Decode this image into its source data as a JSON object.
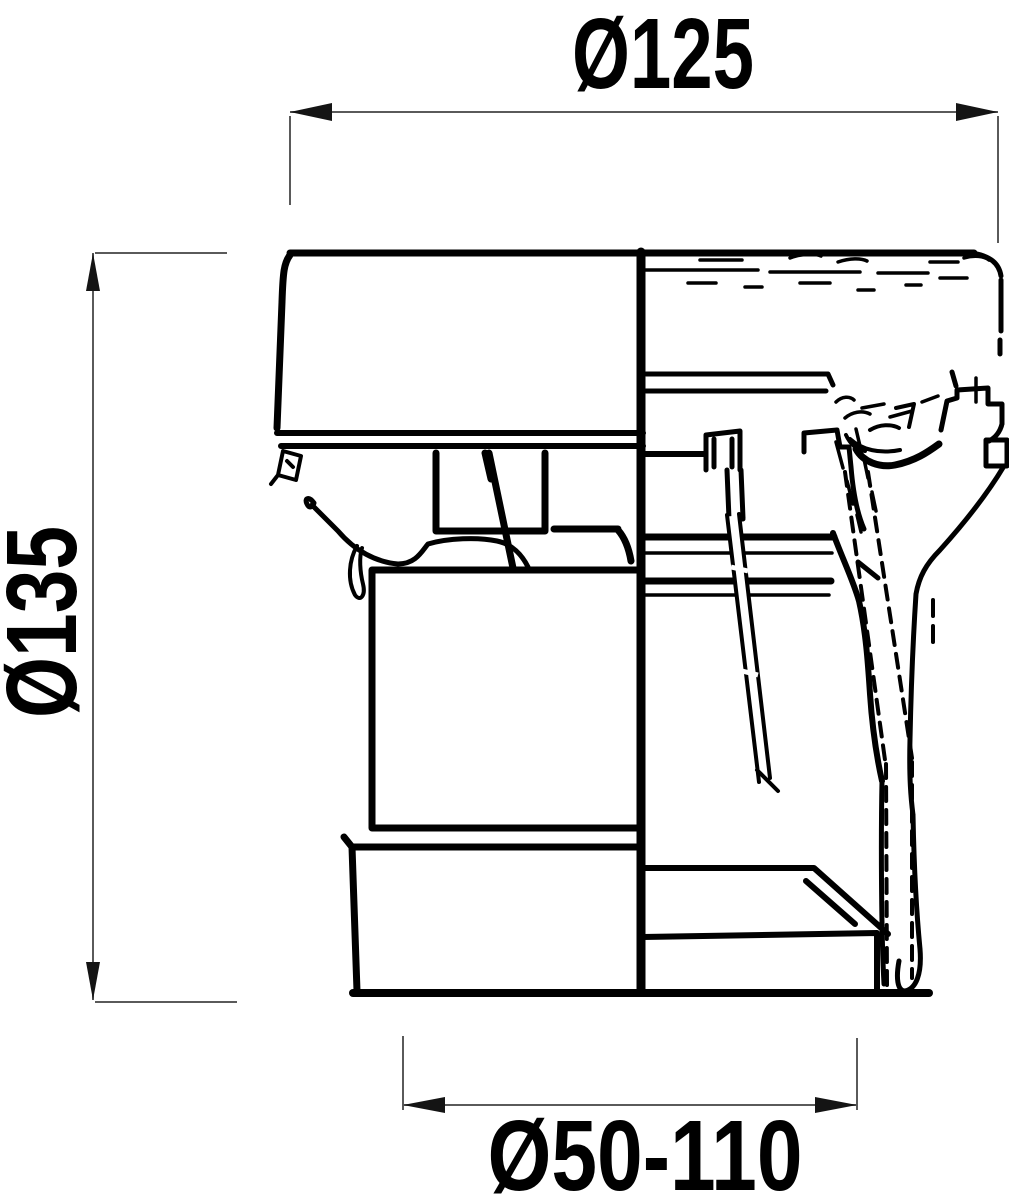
{
  "page": {
    "background": "#ffffff"
  },
  "drawing": {
    "kind": "technical-section-drawing",
    "subject": "vent-cap-cross-section",
    "line_color": "#000000",
    "dimension_line_color": "#5a5a5a",
    "text_color": "#000000",
    "dimensions": {
      "top": {
        "label": "Ø125",
        "value": 125,
        "symbol": "Ø"
      },
      "left": {
        "label": "Ø135",
        "value": 135,
        "symbol": "Ø"
      },
      "bottom": {
        "label": "Ø50-110",
        "min": 50,
        "max": 110,
        "symbol": "Ø"
      }
    }
  }
}
